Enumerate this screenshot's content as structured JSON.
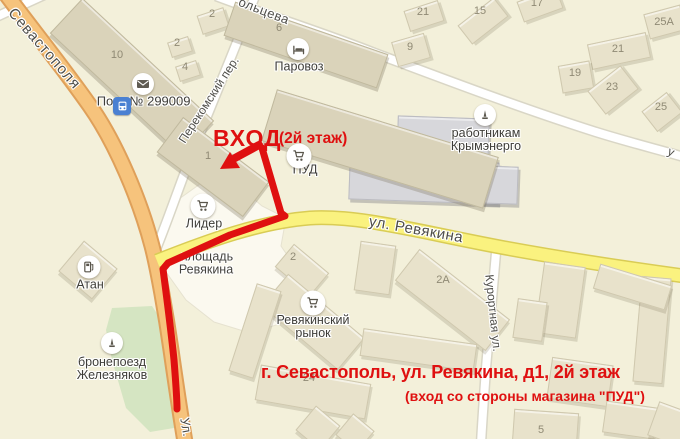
{
  "colors": {
    "accent": "#df1010",
    "background": "#f3f0da",
    "road_orange": "#f6c37c",
    "road_orange_casing": "#dfa05a",
    "road_yellow": "#faf27f",
    "road_yellow_casing": "#d9cc55",
    "road_white": "#ffffff",
    "road_white_casing": "#d9d6c6",
    "building_light": "#e8e2cb",
    "building_dark": "#dad3ba",
    "building_gray": "#d7d7db",
    "green_area": "#d5e5c2",
    "plaza": "#fbf9ef",
    "bus_blue": "#4a80d2"
  },
  "annotations": {
    "entrance": "ВХОД",
    "entrance_note": "(2й этаж)",
    "address_line1": "г. Севастополь, ул. Ревякина, д1, 2й этаж",
    "address_line2": "(вход со стороны магазина \"ПУД\")"
  },
  "street_labels": [
    {
      "text": "Севастополя",
      "x": 44,
      "y": 49,
      "rot": 49,
      "size": 15,
      "ls": 1
    },
    {
      "text": "ольцева",
      "x": 264,
      "y": 11,
      "rot": 21,
      "size": 13,
      "ls": 0.5
    },
    {
      "text": "Перекомский пер.",
      "x": 209,
      "y": 100,
      "rot": -57,
      "size": 12,
      "ls": 0
    },
    {
      "text": "ул. Ревякина",
      "x": 416,
      "y": 230,
      "rot": 10,
      "size": 15,
      "ls": 0.5
    },
    {
      "text": "Курортная ул.",
      "x": 493,
      "y": 313,
      "rot": 84,
      "size": 12,
      "ls": 0
    },
    {
      "text": "Ул.",
      "x": 186,
      "y": 427,
      "rot": 80,
      "size": 13,
      "ls": 0
    },
    {
      "text": "у",
      "x": 671,
      "y": 152,
      "rot": 25,
      "size": 12,
      "ls": 0
    }
  ],
  "area_labels": [
    {
      "text": "площадь",
      "x": 207,
      "y": 257
    },
    {
      "text": "Ревякина",
      "x": 206,
      "y": 270
    }
  ],
  "poi_texts": [
    {
      "text": "По",
      "x": 105,
      "y": 101
    },
    {
      "text": "№ 299009",
      "x": 160,
      "y": 101
    }
  ],
  "building_numbers": [
    {
      "text": "10",
      "x": 117,
      "y": 56
    },
    {
      "text": "2",
      "x": 212,
      "y": 15
    },
    {
      "text": "2",
      "x": 177,
      "y": 44
    },
    {
      "text": "4",
      "x": 185,
      "y": 68
    },
    {
      "text": "6",
      "x": 279,
      "y": 29
    },
    {
      "text": "21",
      "x": 423,
      "y": 13
    },
    {
      "text": "15",
      "x": 480,
      "y": 12
    },
    {
      "text": "17",
      "x": 537,
      "y": 4
    },
    {
      "text": "9",
      "x": 410,
      "y": 48
    },
    {
      "text": "25А",
      "x": 664,
      "y": 23
    },
    {
      "text": "21",
      "x": 618,
      "y": 50
    },
    {
      "text": "19",
      "x": 575,
      "y": 74
    },
    {
      "text": "23",
      "x": 612,
      "y": 88
    },
    {
      "text": "25",
      "x": 661,
      "y": 108
    },
    {
      "text": "1",
      "x": 208,
      "y": 157
    },
    {
      "text": "2",
      "x": 293,
      "y": 258
    },
    {
      "text": "2А",
      "x": 443,
      "y": 281
    },
    {
      "text": "24",
      "x": 309,
      "y": 379
    },
    {
      "text": "5",
      "x": 541,
      "y": 431
    }
  ],
  "pois": [
    {
      "name": "post-office",
      "icon": "envelope",
      "x": 143,
      "y": 84,
      "d": 22,
      "label": ""
    },
    {
      "name": "bus-stop",
      "icon": "bus",
      "x": 122,
      "y": 106,
      "d": 18,
      "label": ""
    },
    {
      "name": "hotel-parovoz",
      "icon": "bed",
      "x": 298,
      "y": 49,
      "d": 22,
      "label": "Паровоз",
      "lx": 299,
      "ly": 67
    },
    {
      "name": "store-pud",
      "icon": "cart",
      "x": 299,
      "y": 156,
      "d": 25,
      "label": "ПУД",
      "lx": 305,
      "ly": 170
    },
    {
      "name": "store-lider",
      "icon": "cart",
      "x": 203,
      "y": 206,
      "d": 25,
      "label": "Лидер",
      "lx": 204,
      "ly": 224
    },
    {
      "name": "market-revyakinsky",
      "icon": "cart",
      "x": 313,
      "y": 303,
      "d": 25,
      "label": "Ревякинский\nрынок",
      "lx": 313,
      "ly": 327
    },
    {
      "name": "fuel-atan",
      "icon": "fuel",
      "x": 89,
      "y": 267,
      "d": 23,
      "label": "Атан",
      "lx": 90,
      "ly": 285
    },
    {
      "name": "monument-zheleznyakov",
      "icon": "monument",
      "x": 112,
      "y": 343,
      "d": 22,
      "label": "бронепоезд\nЖелезняков",
      "lx": 112,
      "ly": 369
    },
    {
      "name": "monument-krymenergo",
      "icon": "monument",
      "x": 485,
      "y": 115,
      "d": 22,
      "label": "работникам\nКрымэнерго",
      "lx": 486,
      "ly": 140
    }
  ],
  "buildings": [
    [
      132,
      77,
      180,
      48,
      43,
      "dark"
    ],
    [
      213,
      21,
      28,
      20,
      -18,
      "light"
    ],
    [
      180,
      47,
      22,
      16,
      -18,
      "light"
    ],
    [
      188,
      71,
      22,
      16,
      -18,
      "light"
    ],
    [
      306,
      45,
      162,
      36,
      19,
      "dark"
    ],
    [
      424,
      16,
      36,
      22,
      -18,
      "light"
    ],
    [
      483,
      21,
      46,
      24,
      -38,
      "light"
    ],
    [
      540,
      5,
      42,
      22,
      -20,
      "light"
    ],
    [
      411,
      50,
      34,
      26,
      -16,
      "light"
    ],
    [
      665,
      22,
      38,
      26,
      -15,
      "light"
    ],
    [
      619,
      51,
      60,
      26,
      -12,
      "light"
    ],
    [
      576,
      77,
      32,
      28,
      -10,
      "light"
    ],
    [
      613,
      90,
      42,
      30,
      -38,
      "light"
    ],
    [
      662,
      112,
      32,
      26,
      -38,
      "light"
    ],
    [
      443,
      141,
      92,
      48,
      2,
      "gray"
    ],
    [
      424,
      181,
      150,
      42,
      2,
      "gray"
    ],
    [
      497,
      185,
      42,
      38,
      2,
      "gray"
    ],
    [
      213,
      167,
      108,
      44,
      37,
      "dark"
    ],
    [
      380,
      149,
      232,
      54,
      17,
      "dark"
    ],
    [
      302,
      270,
      46,
      30,
      40,
      "light"
    ],
    [
      313,
      322,
      100,
      42,
      40,
      "light"
    ],
    [
      255,
      331,
      26,
      92,
      18,
      "light"
    ],
    [
      88,
      270,
      44,
      40,
      40,
      "light"
    ],
    [
      452,
      300,
      115,
      40,
      38,
      "light"
    ],
    [
      375,
      268,
      36,
      50,
      8,
      "light"
    ],
    [
      418,
      350,
      115,
      28,
      8,
      "light"
    ],
    [
      313,
      392,
      112,
      36,
      10,
      "light"
    ],
    [
      318,
      428,
      32,
      32,
      40,
      "light"
    ],
    [
      355,
      433,
      28,
      28,
      40,
      "light"
    ],
    [
      545,
      428,
      65,
      34,
      4,
      "light"
    ],
    [
      560,
      300,
      42,
      72,
      8,
      "light"
    ],
    [
      652,
      330,
      30,
      106,
      5,
      "light"
    ],
    [
      632,
      287,
      75,
      26,
      17,
      "light"
    ],
    [
      580,
      382,
      62,
      42,
      8,
      "light"
    ],
    [
      630,
      420,
      52,
      32,
      8,
      "light"
    ],
    [
      530,
      320,
      30,
      40,
      8,
      "light"
    ],
    [
      672,
      425,
      40,
      36,
      20,
      "light"
    ]
  ]
}
